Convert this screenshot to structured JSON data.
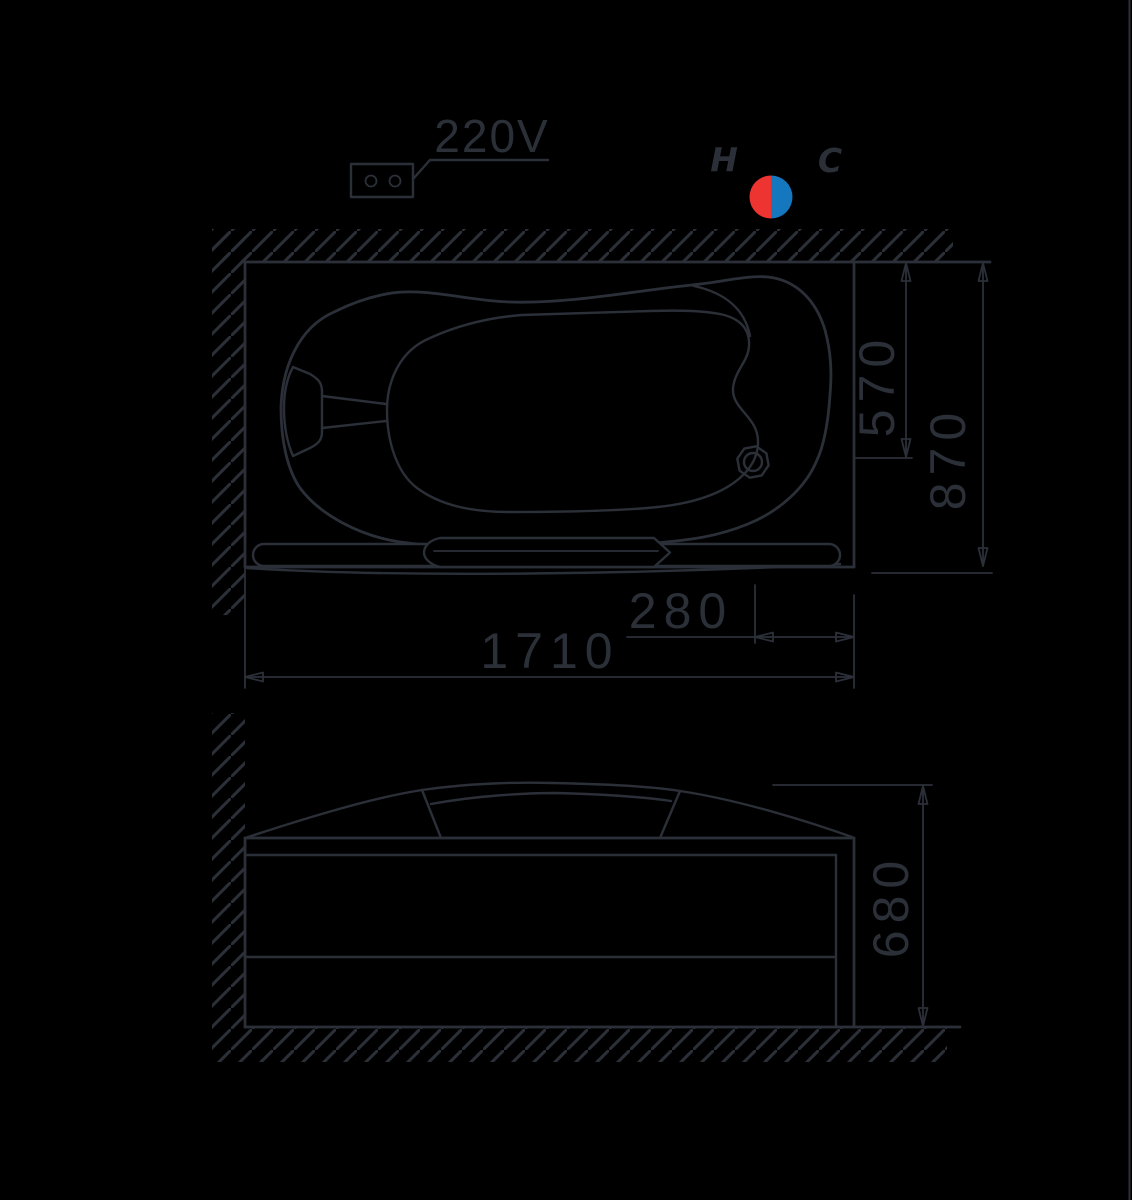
{
  "labels": {
    "voltage": "220V",
    "hot": "H",
    "cold": "C"
  },
  "dimensions": {
    "overall_length": "1710",
    "overall_depth": "870",
    "drain_from_back_wall": "570",
    "drain_from_right_end": "280",
    "tub_height": "680"
  },
  "colors": {
    "background": "#000000",
    "line": "#2b2f38",
    "hot_red": "#ee3430",
    "cold_blue": "#1577bd"
  },
  "icons": [
    {
      "name": "power-outlet-icon",
      "meaning": "220V electrical connection point"
    },
    {
      "name": "hot-cold-indicator-icon",
      "meaning": "hot and cold water supply position"
    }
  ]
}
